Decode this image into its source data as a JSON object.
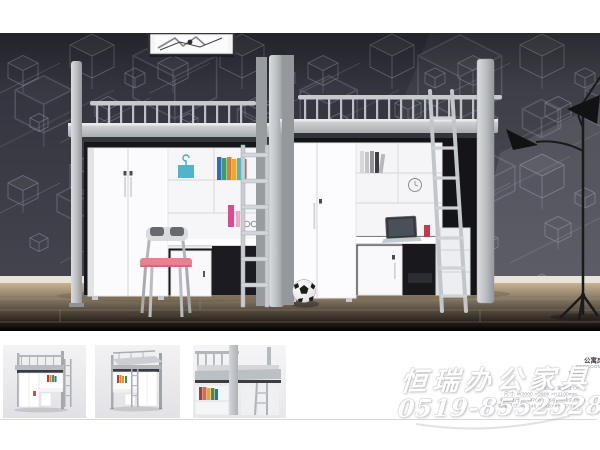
{
  "watermark": {
    "company": "恒瑞办公家具",
    "phone": "0519-85525283"
  },
  "specs": {
    "title": "公寓床",
    "category": "BEDROOM",
    "model": "TC-100",
    "lines": [
      "颜色: 宝石白 OEM",
      "尺寸: W2000 ×D900 ×H2100mm",
      "电脑桌尺寸: W700 ×D600 ×H1570mm",
      "梯柜尺寸: W1140 ×D620 ×H1570mm"
    ]
  },
  "thumbnails": [
    {
      "label": "loft-bed-angle-view"
    },
    {
      "label": "loft-bed-front-view"
    },
    {
      "label": "loft-bed-detail-view"
    }
  ],
  "colors": {
    "wall": "#383841",
    "floor": "#d9c8ab",
    "metal": "#b8bbbf",
    "accent_pink": "#e8808f",
    "watermark": "#ffffff"
  }
}
